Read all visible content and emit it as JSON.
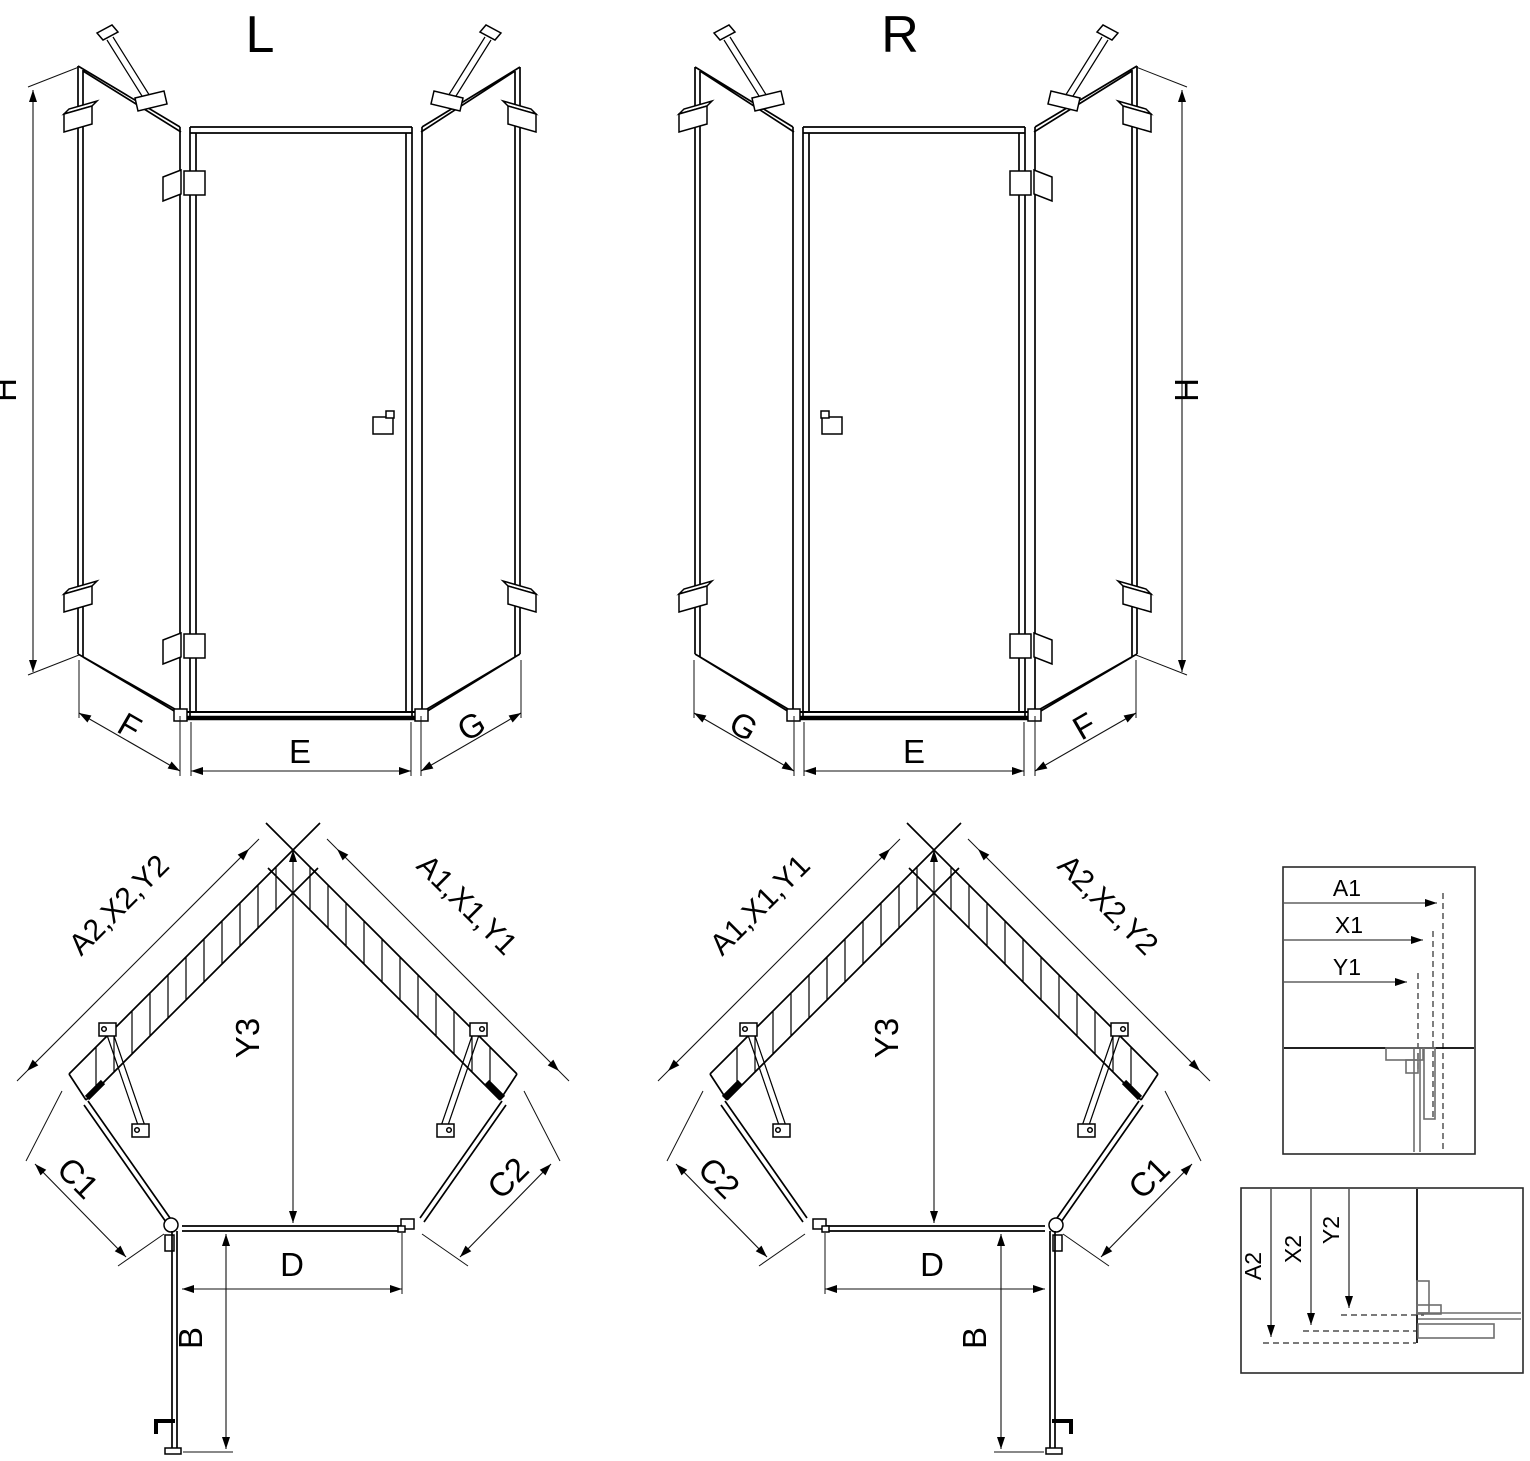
{
  "drawing": {
    "variant_left": {
      "title": "L",
      "height": "H",
      "side_left": "F",
      "front": "E",
      "side_right": "G",
      "wall_left": "A2,X2,Y2",
      "wall_right": "A1,X1,Y1",
      "depth": "Y3",
      "panel_left": "C1",
      "panel_right": "C2",
      "door_width": "D",
      "door_open": "B"
    },
    "variant_right": {
      "title": "R",
      "height": "H",
      "side_left": "G",
      "front": "E",
      "side_right": "F",
      "wall_left": "A1,X1,Y1",
      "wall_right": "A2,X2,Y2",
      "depth": "Y3",
      "panel_left": "C2",
      "panel_right": "C1",
      "door_width": "D",
      "door_open": "B"
    },
    "detail_top": {
      "dim1": "A1",
      "dim2": "X1",
      "dim3": "Y1"
    },
    "detail_bottom": {
      "dim1": "A2",
      "dim2": "X2",
      "dim3": "Y2"
    }
  },
  "colors": {
    "line": "#000000",
    "profile_gray": "#6e6e6e",
    "background": "#ffffff"
  }
}
